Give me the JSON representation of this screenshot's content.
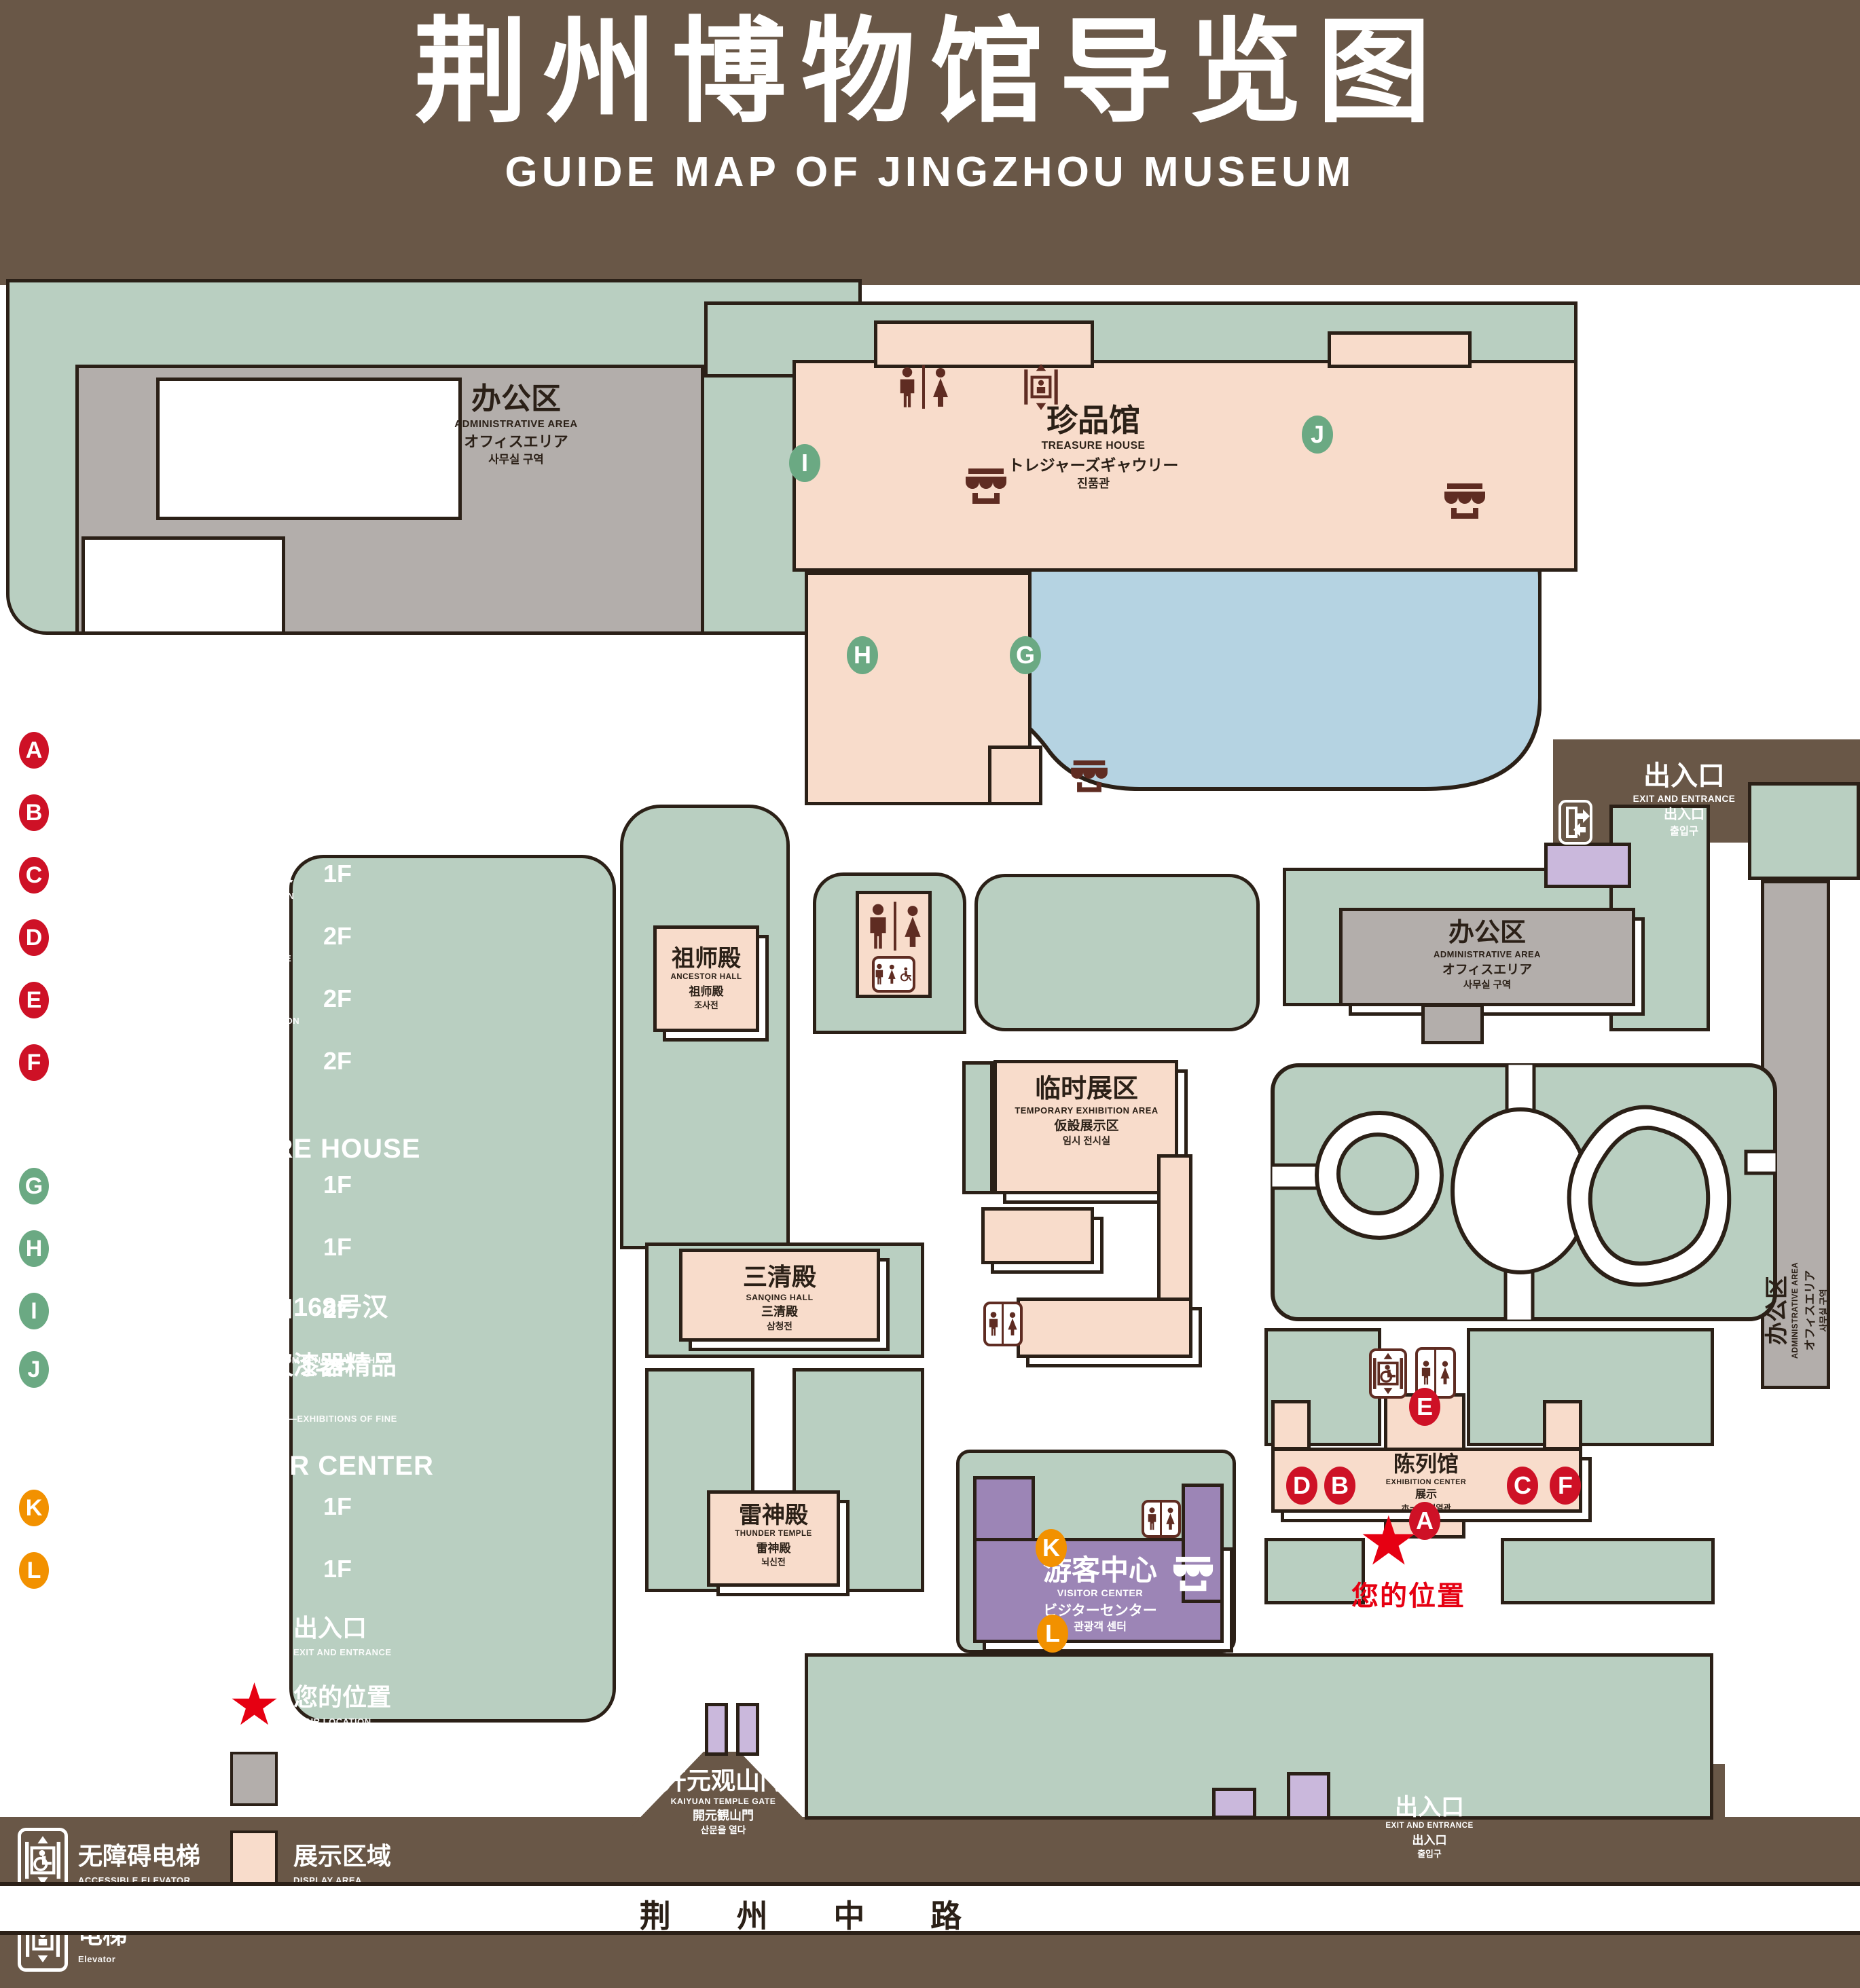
{
  "title": {
    "zh": "荆州博物馆导览图",
    "en": "GUIDE MAP OF JINGZHOU MUSEUM"
  },
  "colors": {
    "background": "#695747",
    "park_green": "#b9cfc1",
    "display_pink": "#f8dccb",
    "office_gray": "#b3aeab",
    "pond_blue": "#b5d3e2",
    "visitor_purple": "#9c85b6",
    "gate_purple": "#cab8dc",
    "icon_maroon": "#5f2c22",
    "badge_red": "#ce1126",
    "badge_green": "#6ba983",
    "badge_orange": "#f29100",
    "location_red": "#e60012",
    "outline": "#2b2017"
  },
  "legend": {
    "sections": [
      {
        "zh": "陈列馆",
        "en": "EXHIBITION CENTER",
        "items": [
          {
            "badge": "A",
            "zh": "《火中的凤凰》壁画",
            "en": "THE PHOENIX IN FIRE \"MURAL PAINTING",
            "floor": "1F"
          },
          {
            "badge": "B",
            "zh": "荆州出土铜器展",
            "en": "JINGZHOU UNEARTHED BRONZE WARE EXHIBITION",
            "floor": "1F"
          },
          {
            "badge": "C",
            "zh": "江汉平原原始文化展",
            "en": "JIANGHAN PLAIN PRIMITIVE CULTURE EXHIBITION",
            "floor": "1F"
          },
          {
            "badge": "D",
            "zh": "荆州出土瓷器展",
            "en": "JINGZHOU UNEARTHED PORCELAIN EXHIBITIONE",
            "floor": "2F"
          },
          {
            "badge": "E",
            "zh": "荆州出土简牍展",
            "en": "JINGZHOU EXCAVATED BAMBOO SLIPS EXHIBITION",
            "floor": "2F"
          },
          {
            "badge": "F",
            "zh": "荆州出土玉器展",
            "en": "JINGZHOU UNEARTHED JADE EXHIBITION",
            "floor": "2F"
          }
        ]
      },
      {
        "zh": "珍品馆",
        "en": "TREASURE HOUSE",
        "items": [
          {
            "badge": "G",
            "zh": "放映厅",
            "en": "PROJECTION HALL",
            "floor": "1F"
          },
          {
            "badge": "H",
            "zh": "互动体验厅",
            "en": "INTERACTIVE EXPERIENCE HALL",
            "floor": "1F"
          },
          {
            "badge": "I",
            "zh": "五大夫遂——凤凰山168号汉墓展",
            "en": "WUDAFU—EXHIBITION OF NO.168 HAN TOMB FROM FENGHUANGSHAN",
            "floor": "2F"
          },
          {
            "badge": "J",
            "zh": "丹漆神韵——楚秦汉漆器精品展",
            "en": "ROMANTIC CHARM OF THE CRIMSON LACQUERS—EXHIBITIONS OF FINE LACQUERS FROM CHU,QIN AND HAN DYNASTIES",
            "floor": "1-2F"
          }
        ]
      },
      {
        "zh": "游客中心",
        "en": "VISITOR CENTER",
        "items": [
          {
            "badge": "K",
            "zh": "安全保卫",
            "en": "SECURITY",
            "floor": "1F"
          },
          {
            "badge": "L",
            "zh": "医疗点",
            "en": "CLINIC",
            "floor": "1F"
          }
        ]
      }
    ],
    "symbols": [
      {
        "icon": "store-icon",
        "zh": "文创商店",
        "en": "STORE"
      },
      {
        "icon": "exit-icon",
        "zh": "出入口",
        "en": "EXIT AND ENTRANCE"
      },
      {
        "icon": "restroom-icon",
        "zh": "卫生间",
        "en": "RESTROOMS"
      },
      {
        "icon": "location-star-icon",
        "zh": "您的位置",
        "en": "YOUR LOCATION"
      },
      {
        "icon": "family-restroom-icon",
        "zh": "家庭卫生间",
        "en": "FAMILY RESTROOMS"
      },
      {
        "icon": "office-area-swatch",
        "zh": "办公区域",
        "en": "OFFICE AREA"
      },
      {
        "icon": "accessible-elevator-icon",
        "zh": "无障碍电梯",
        "en": "ACCESSIBLE ELEVATOR"
      },
      {
        "icon": "display-area-swatch",
        "zh": "展示区域",
        "en": "DISPLAY AREA"
      },
      {
        "icon": "elevator-icon",
        "zh": "电梯",
        "en": "Elevator"
      }
    ]
  },
  "map": {
    "buildings": {
      "admin_top": {
        "zh": "办公区",
        "en": "ADMINISTRATIVE AREA",
        "ja": "オフィスエリア",
        "ko": "사무실 구역"
      },
      "treasure": {
        "zh": "珍品馆",
        "en": "TREASURE HOUSE",
        "ja": "トレジャーズギャウリー",
        "ko": "진품관"
      },
      "ancestor": {
        "zh": "祖师殿",
        "en": "ANCESTOR HALL",
        "ja": "祖师殿",
        "ko": "조사전"
      },
      "temporary": {
        "zh": "临时展区",
        "en": "TEMPORARY EXHIBITION AREA",
        "ja": "仮設展示区",
        "ko": "임시 전시실"
      },
      "admin_right": {
        "zh": "办公区",
        "en": "ADMINISTRATIVE AREA",
        "ja": "オフィスエリア",
        "ko": "사무실 구역"
      },
      "admin_side": {
        "zh": "办公区",
        "en": "ADMINISTRATIVE AREA",
        "ja": "オフィスエリア",
        "ko": "사무실 구역"
      },
      "sanqing": {
        "zh": "三清殿",
        "en": "SANQING HALL",
        "ja": "三清殿",
        "ko": "삼청전"
      },
      "thunder": {
        "zh": "雷神殿",
        "en": "THUNDER TEMPLE",
        "ja": "雷神殿",
        "ko": "뇌신전"
      },
      "visitor": {
        "zh": "游客中心",
        "en": "VISITOR CENTER",
        "ja": "ビジターセンター",
        "ko": "관광객 센터"
      },
      "exhibition": {
        "zh": "陈列馆",
        "en": "EXHIBITION CENTER",
        "ja": "展示",
        "ko": "ホール 진열관"
      },
      "gate": {
        "zh": "开元观山门",
        "en": "KAIYUAN TEMPLE GATE",
        "ja": "開元観山門",
        "ko": "산문을 열다"
      }
    },
    "exit_top": {
      "zh": "出入口",
      "en": "EXIT AND ENTRANCE",
      "ja": "出入口",
      "ko": "출입구"
    },
    "exit_bottom": {
      "zh": "出入口",
      "en": "EXIT AND ENTRANCE",
      "ja": "出入口",
      "ko": "출입구"
    },
    "road": "荆 州 中 路",
    "your_location": "您的位置",
    "location_star": "★",
    "badge_letters": [
      "A",
      "B",
      "C",
      "D",
      "E",
      "F",
      "G",
      "H",
      "I",
      "J",
      "K",
      "L"
    ]
  }
}
